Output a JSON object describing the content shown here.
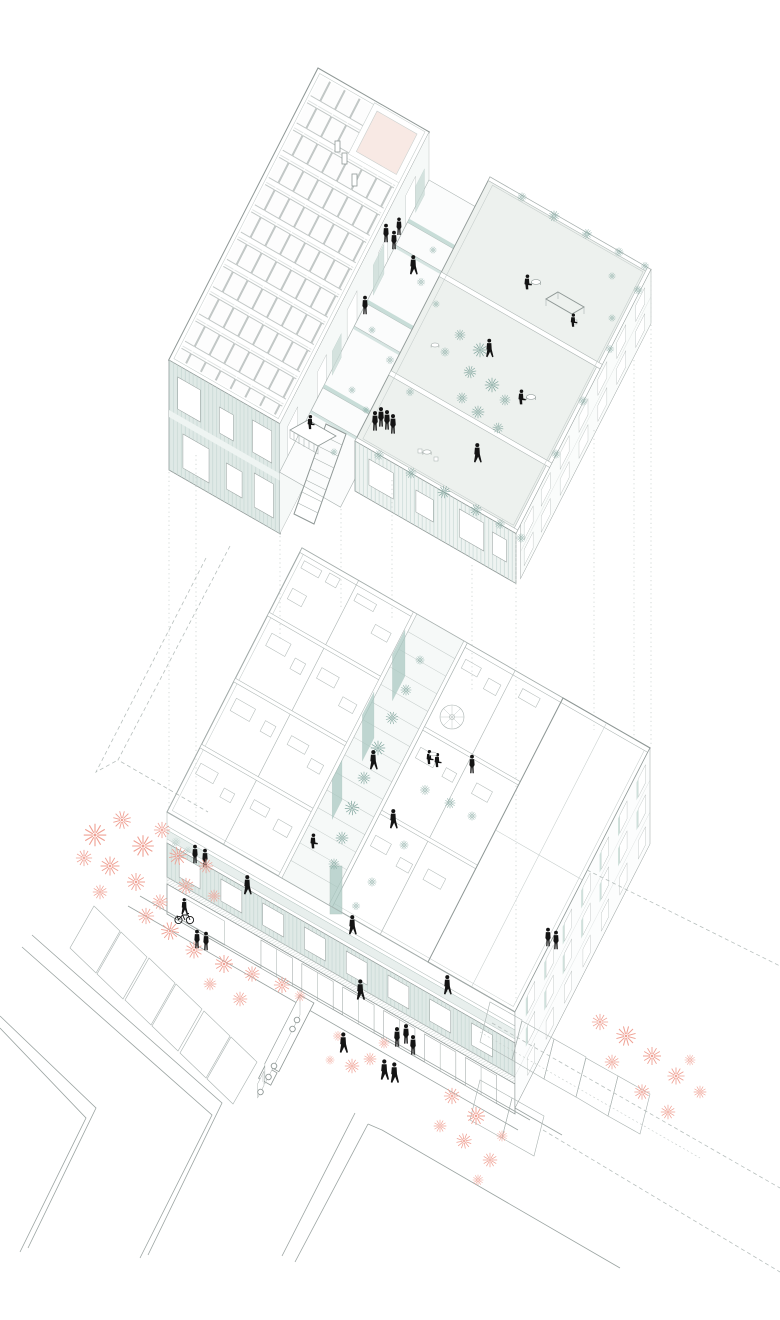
{
  "canvas": {
    "width": 780,
    "height": 1320,
    "background": "#ffffff"
  },
  "palette": {
    "ink": "#141414",
    "line": "#8f9896",
    "line_light": "#aab3b1",
    "line_faint": "#c2cac8",
    "facade_teal": "#dfe9e6",
    "facade_hatch": "#c6d7d3",
    "terrace_floor": "#edf1ee",
    "deck_floor": "#f6f9f8",
    "glass_teal": "#c7dad5",
    "panel_teal": "#a9c8c1",
    "plant_teal": "#7fa49c",
    "tree_coral": "#efa093",
    "tree_center": "#cf6a55",
    "skylight_pink": "#f8e9e4",
    "street_line": "#9aa3a1",
    "dash_line": "#b7bfbd"
  },
  "scene": {
    "type": "exploded-axonometric-architecture-drawing",
    "upper_level": {
      "label": "roof level: photovoltaic array, pink skylight, walkway bridges, planted roof terraces with tables",
      "roof_terraces": 3,
      "walkway_bridges": 3,
      "solar_panel_wing": true,
      "people": 15
    },
    "lower_level": {
      "label": "apartment floor cut-away: rooms, central planted courtyard, spiral stair, teal street facades",
      "apartment_wings": 2,
      "spiral_stair": true,
      "people": 11
    },
    "street_level": {
      "label": "street corner: sidewalks, parking bays, coral trees, delivery truck, cyclist, pedestrians",
      "truck": true,
      "cyclist": true,
      "people": 12,
      "parking_bays": 13,
      "tree_clusters": 5
    }
  }
}
